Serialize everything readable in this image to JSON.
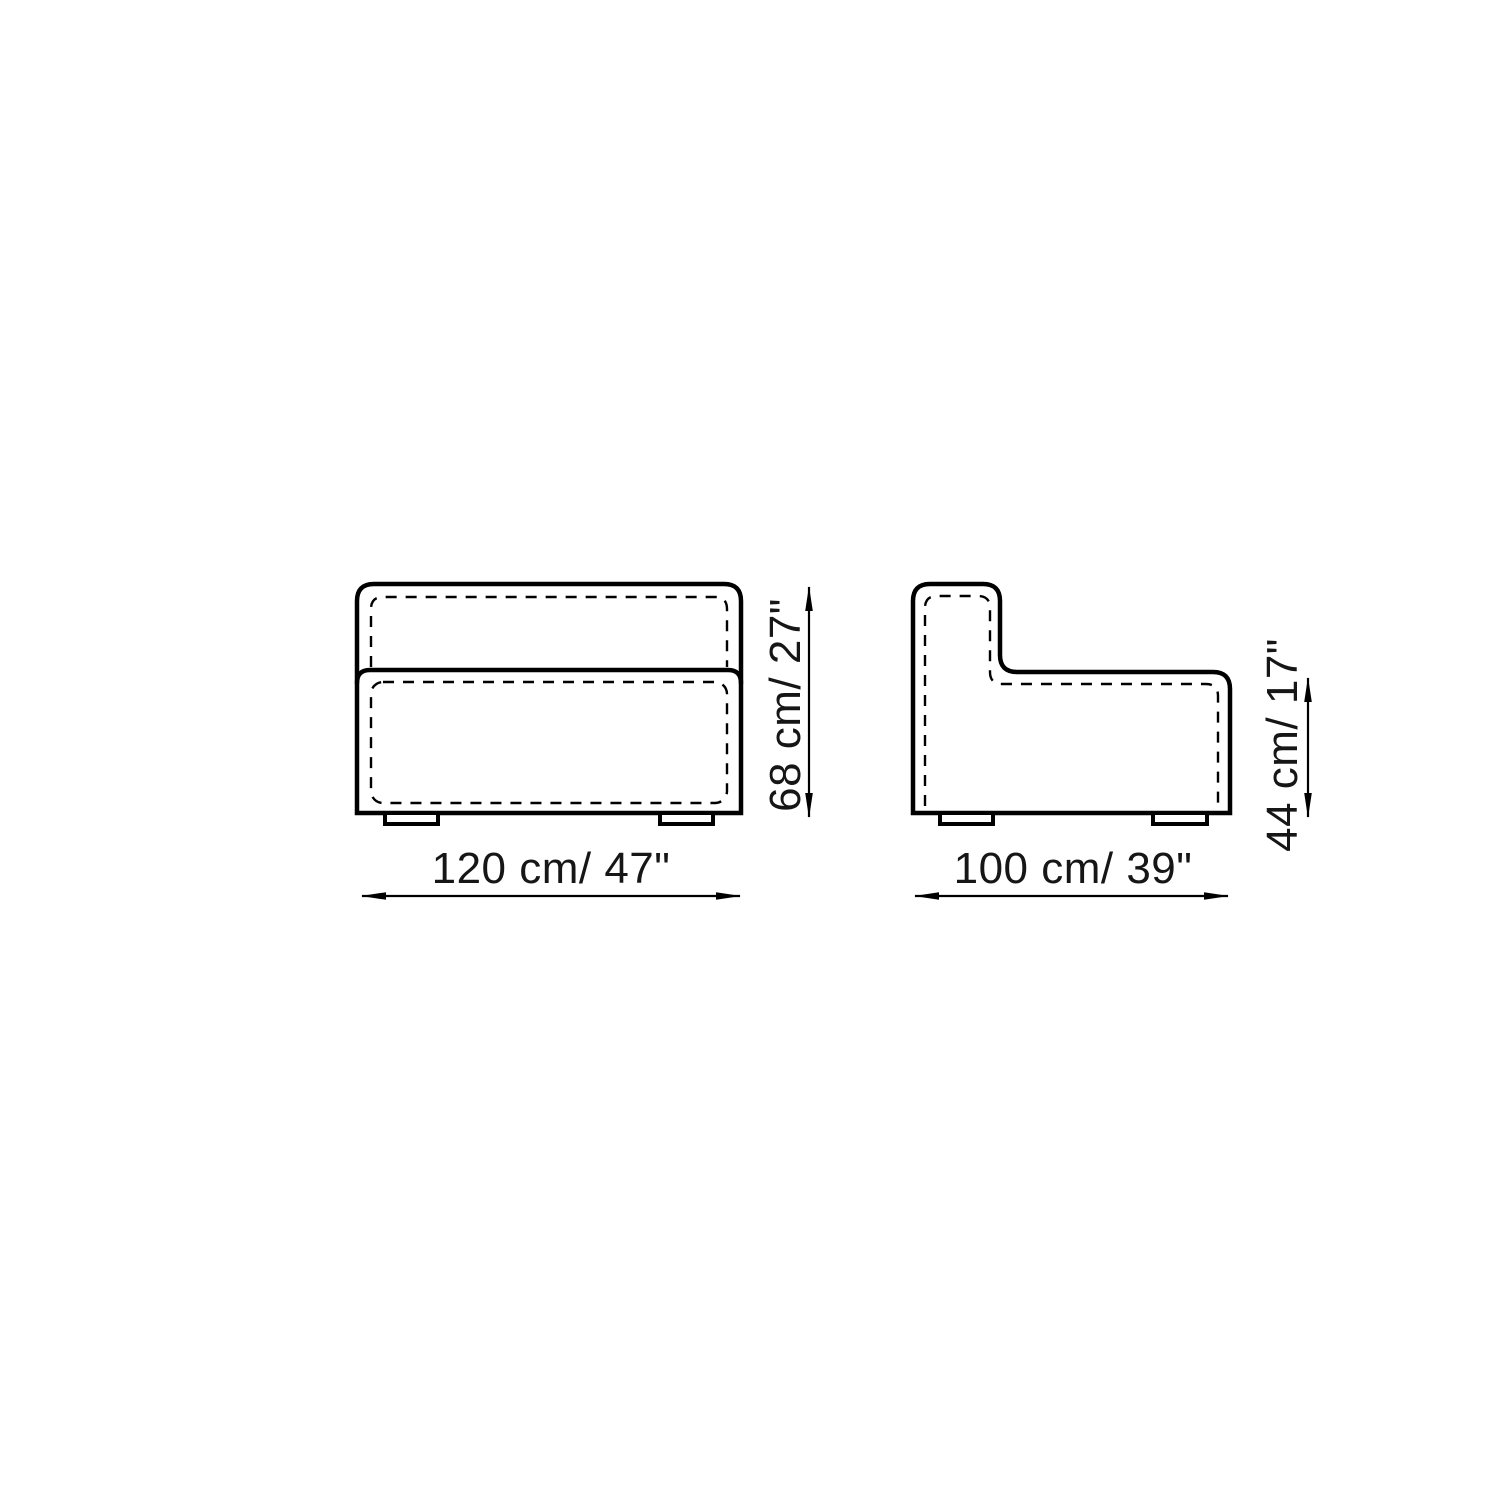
{
  "colors": {
    "background": "#ffffff",
    "line": "#000000",
    "text": "#161616"
  },
  "drawing": {
    "type": "furniture-dimension-diagram",
    "subject": "sofa-module",
    "front_view": {
      "width_label": "120 cm/ 47\"",
      "height_label": "68 cm/ 27\""
    },
    "side_view": {
      "depth_label": "100 cm/ 39\"",
      "seat_height_label": "44 cm/ 17\""
    }
  }
}
